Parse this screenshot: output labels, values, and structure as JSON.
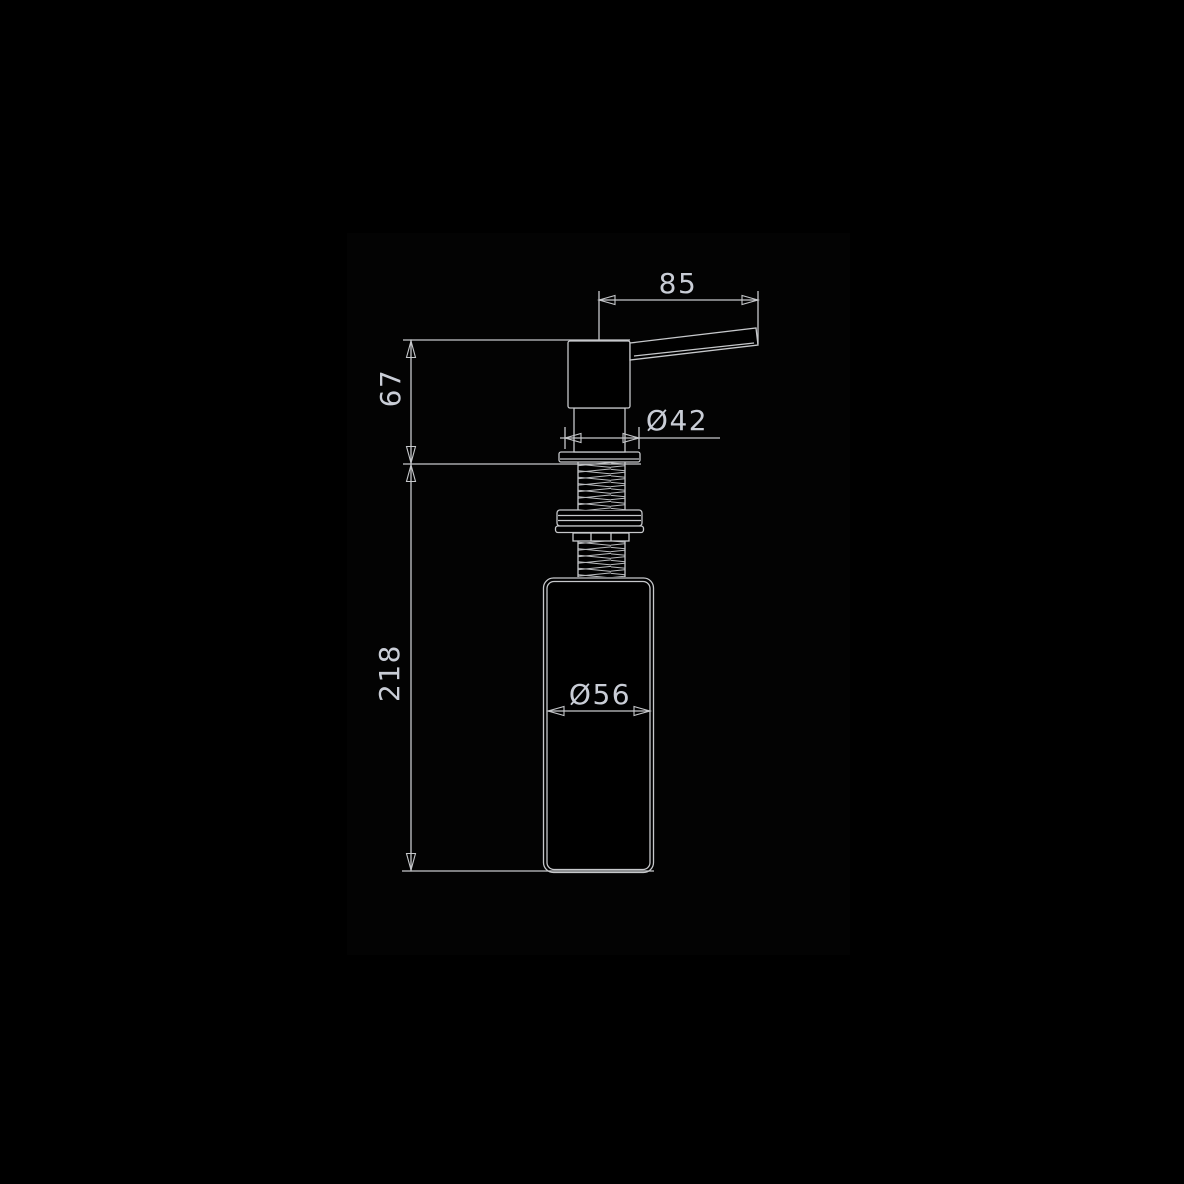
{
  "drawing": {
    "type": "technical-dimension-drawing",
    "subject": "soap-dispenser-side-view",
    "dimensions": {
      "spout_length": "85",
      "head_height": "67",
      "flange_diameter": "Ø42",
      "total_body_height": "218",
      "bottle_diameter": "Ø56"
    },
    "colors": {
      "background": "#000000",
      "plate": "#030303",
      "line": "#c6c8cb",
      "thread": "#b9bbbe",
      "text": "#c9cdd6"
    }
  }
}
